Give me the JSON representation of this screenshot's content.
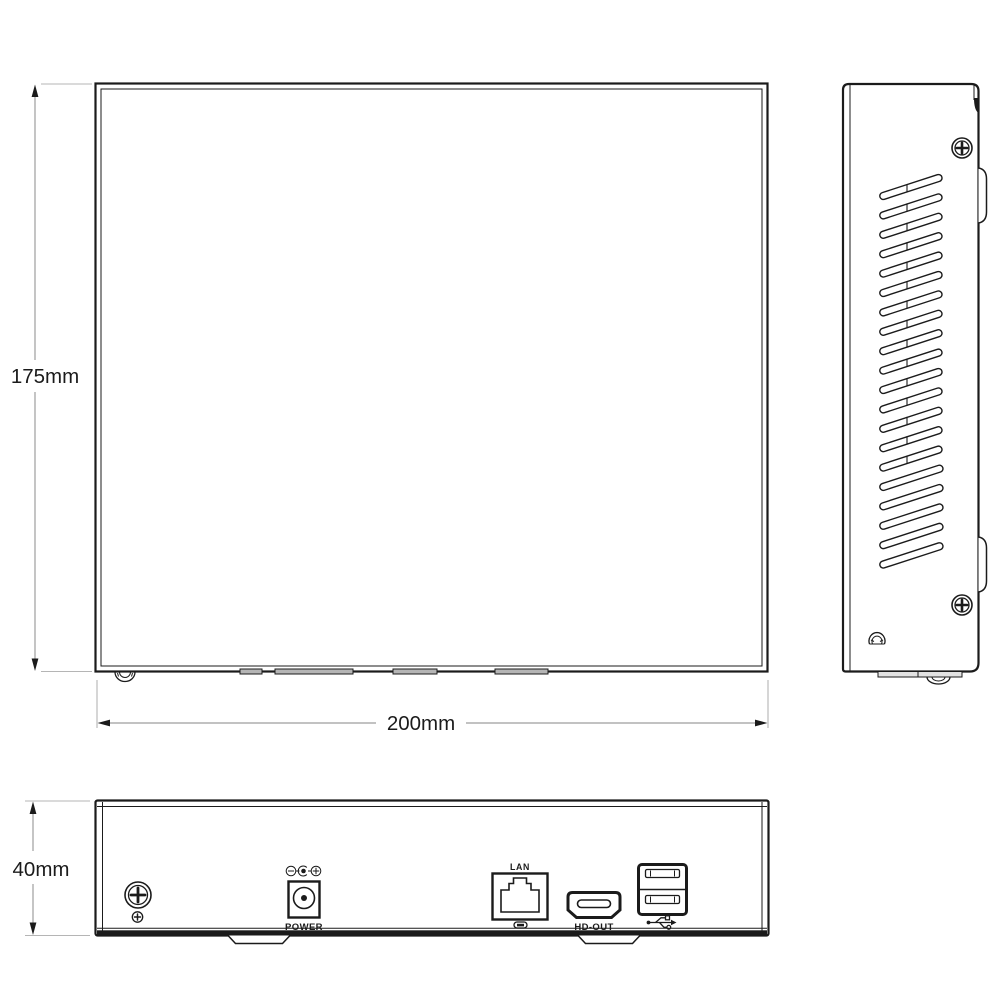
{
  "dimensions": {
    "height_label": "175mm",
    "width_label": "200mm",
    "depth_label": "40mm"
  },
  "rear_panel": {
    "power_label": "POWER",
    "lan_label": "LAN",
    "hdmi_label": "HD-OUT"
  },
  "side_panel": {
    "vents": {
      "paired_rows": 15,
      "single_rows": 5
    }
  },
  "icons": [
    "phillips-screw-icon",
    "ground-screw-icon",
    "dc-power-jack-icon",
    "dc-polarity-icon",
    "rj45-port-icon",
    "lan-led-icon",
    "hdmi-connector-icon",
    "usb-ports-icon",
    "usb-trident-icon",
    "rubber-foot-icon",
    "dome-foot-icon",
    "vent-slots",
    "dimension-arrow-icon"
  ],
  "colors": {
    "line": "#1b1b1b",
    "dimension_line": "#9e9e9e",
    "extension_line": "#b5b5b5",
    "tab_fill": "#b5b5b5",
    "background": "#ffffff"
  }
}
